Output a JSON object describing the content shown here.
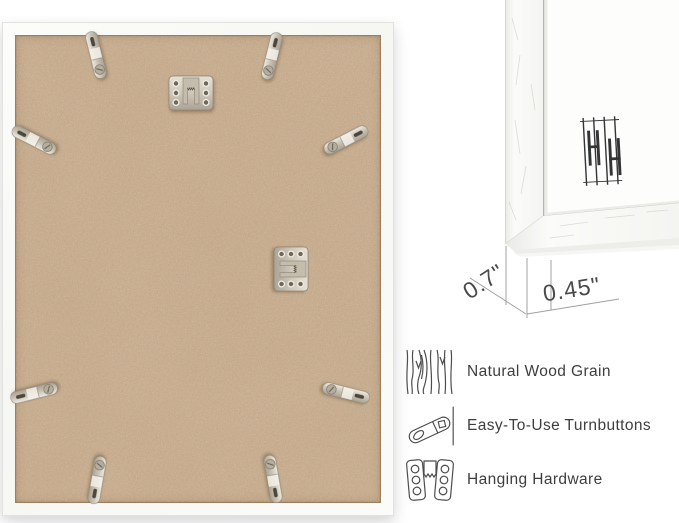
{
  "back_view": {
    "description": "frame-back-with-mdf-board",
    "turnbutton_count": 8,
    "sawtooth_hanger_count": 2
  },
  "corner_closeup": {
    "logo": "hh-monogram",
    "measurements": {
      "side_depth": "0.7\"",
      "face_width": "0.45\""
    }
  },
  "features": [
    {
      "icon": "wood-grain-icon",
      "label": "Natural Wood Grain"
    },
    {
      "icon": "turnbutton-icon",
      "label": "Easy-To-Use Turnbuttons"
    },
    {
      "icon": "hanging-hardware-icon",
      "label": "Hanging Hardware"
    }
  ],
  "colors": {
    "background": "#ffffff",
    "frame_white": "#fafaf8",
    "mdf_base": "#c2a485",
    "metal": "#cdc6b8",
    "label_text": "#3e3e3e",
    "dimension_line": "#a0a0a0",
    "logo_ink": "#333436"
  }
}
